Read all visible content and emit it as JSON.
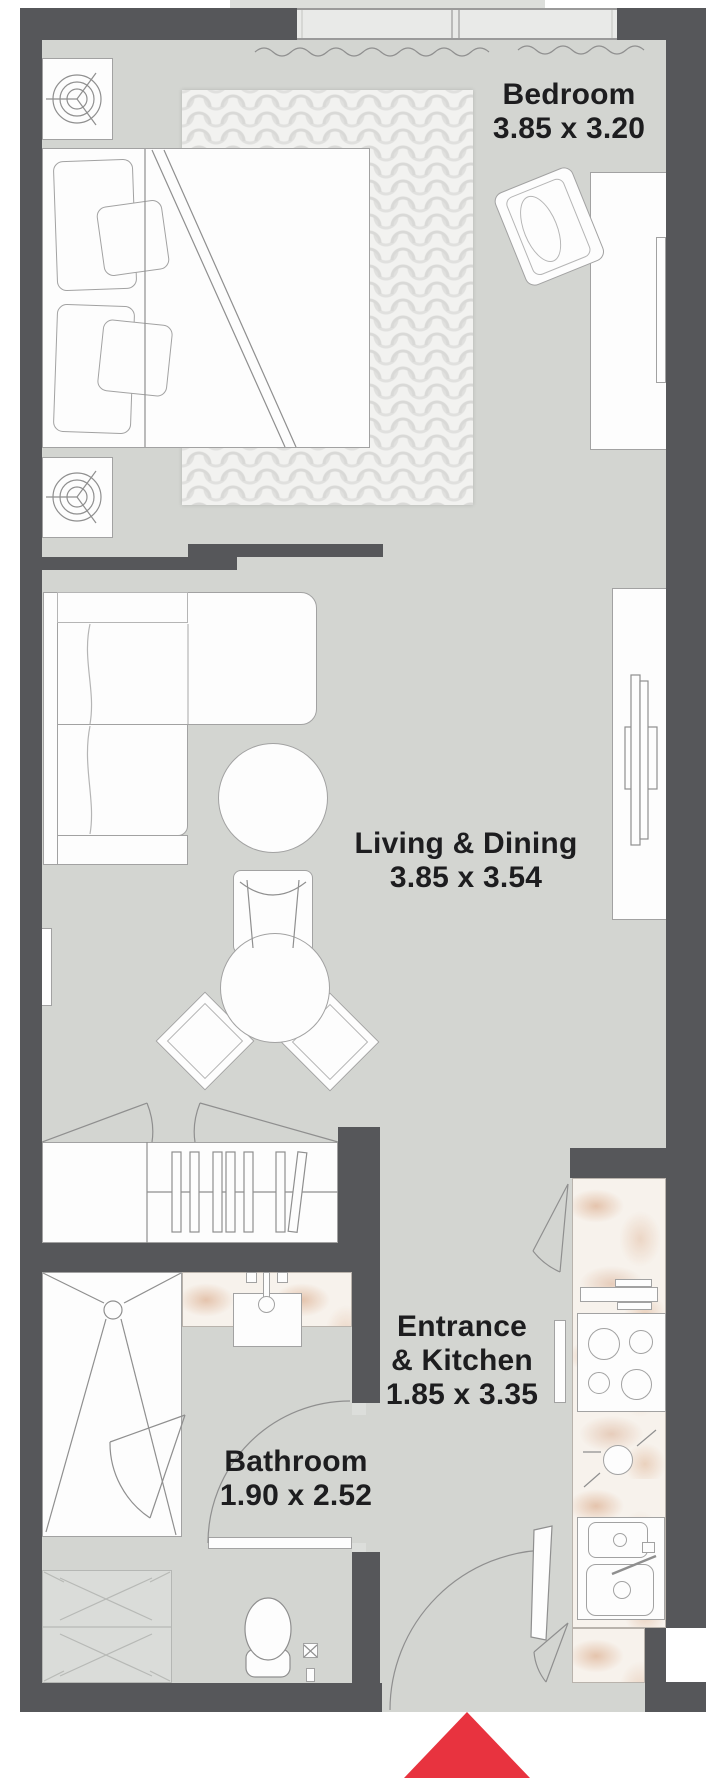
{
  "document": {
    "type": "apartment-floor-plan",
    "units_note": "dimensions shown in metres on plan"
  },
  "rooms": {
    "bedroom": {
      "name": "Bedroom",
      "dimensions": "3.85 x 3.20"
    },
    "living_dining": {
      "name": "Living & Dining",
      "dimensions": "3.85 x 3.54"
    },
    "entrance_kitchen": {
      "name_line1": "Entrance",
      "name_line2": "& Kitchen",
      "dimensions": "1.85 x 3.35"
    },
    "bathroom": {
      "name": "Bathroom",
      "dimensions": "1.90 x 2.52"
    }
  },
  "entrance_marker": {
    "shape": "triangle-up",
    "color": "#e8333f"
  },
  "palette": {
    "wall": "#56575a",
    "floor": "#d3d5d1",
    "furniture_fill": "#fdfdfd",
    "furniture_line": "#a2a2a2",
    "marble_base": "#f7f2ec",
    "text": "#1d1d1f",
    "background": "#ffffff"
  }
}
